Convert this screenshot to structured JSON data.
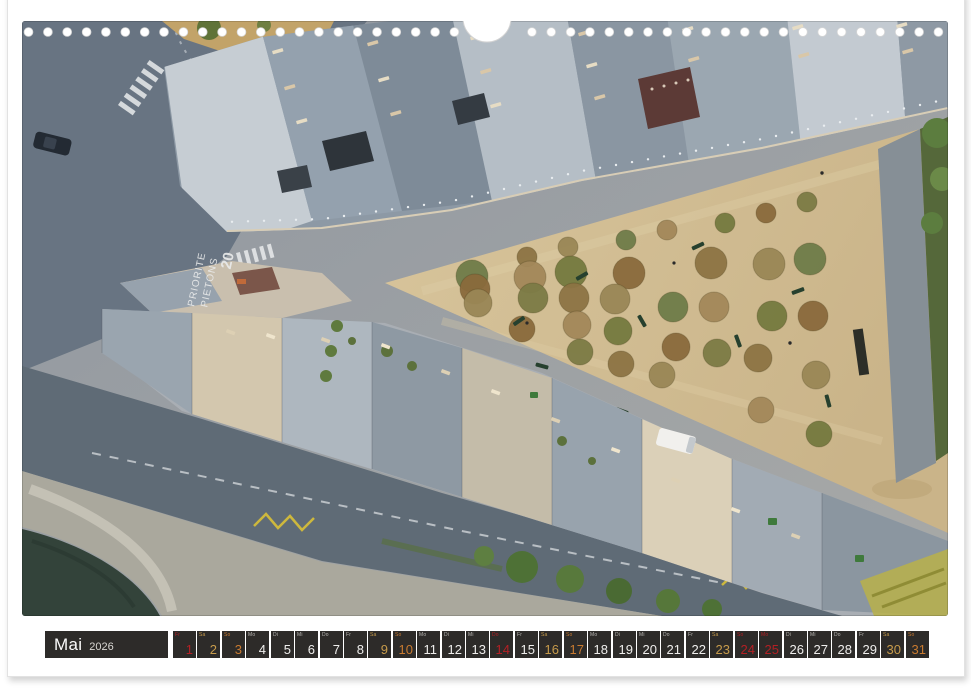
{
  "calendar_strip": {
    "month": "Mai",
    "year": "2026",
    "colors": {
      "cell_background": "#2d2b29",
      "weekday_text": "#efeeec",
      "weekday_label": "#b9b7b3",
      "saturday_text": "#c79b4b",
      "sunday_text": "#c87a30",
      "holiday_text": "#b32024"
    },
    "days": [
      {
        "date": "1",
        "weekday": "Fr",
        "kind": "holiday"
      },
      {
        "date": "2",
        "weekday": "Sa",
        "kind": "saturday"
      },
      {
        "date": "3",
        "weekday": "So",
        "kind": "sunday"
      },
      {
        "date": "4",
        "weekday": "Mo",
        "kind": "weekday"
      },
      {
        "date": "5",
        "weekday": "Di",
        "kind": "weekday"
      },
      {
        "date": "6",
        "weekday": "Mi",
        "kind": "weekday"
      },
      {
        "date": "7",
        "weekday": "Do",
        "kind": "weekday"
      },
      {
        "date": "8",
        "weekday": "Fr",
        "kind": "weekday"
      },
      {
        "date": "9",
        "weekday": "Sa",
        "kind": "saturday"
      },
      {
        "date": "10",
        "weekday": "So",
        "kind": "sunday"
      },
      {
        "date": "11",
        "weekday": "Mo",
        "kind": "weekday"
      },
      {
        "date": "12",
        "weekday": "Di",
        "kind": "weekday"
      },
      {
        "date": "13",
        "weekday": "Mi",
        "kind": "weekday"
      },
      {
        "date": "14",
        "weekday": "Do",
        "kind": "holiday"
      },
      {
        "date": "15",
        "weekday": "Fr",
        "kind": "weekday"
      },
      {
        "date": "16",
        "weekday": "Sa",
        "kind": "saturday"
      },
      {
        "date": "17",
        "weekday": "So",
        "kind": "sunday"
      },
      {
        "date": "18",
        "weekday": "Mo",
        "kind": "weekday"
      },
      {
        "date": "19",
        "weekday": "Di",
        "kind": "weekday"
      },
      {
        "date": "20",
        "weekday": "Mi",
        "kind": "weekday"
      },
      {
        "date": "21",
        "weekday": "Do",
        "kind": "weekday"
      },
      {
        "date": "22",
        "weekday": "Fr",
        "kind": "weekday"
      },
      {
        "date": "23",
        "weekday": "Sa",
        "kind": "saturday"
      },
      {
        "date": "24",
        "weekday": "So",
        "kind": "holiday"
      },
      {
        "date": "25",
        "weekday": "Mo",
        "kind": "holiday"
      },
      {
        "date": "26",
        "weekday": "Di",
        "kind": "weekday"
      },
      {
        "date": "27",
        "weekday": "Mi",
        "kind": "weekday"
      },
      {
        "date": "28",
        "weekday": "Do",
        "kind": "weekday"
      },
      {
        "date": "29",
        "weekday": "Fr",
        "kind": "weekday"
      },
      {
        "date": "30",
        "weekday": "Sa",
        "kind": "saturday"
      },
      {
        "date": "31",
        "weekday": "So",
        "kind": "sunday"
      }
    ]
  },
  "photo": {
    "description": "Aerial top-down view of Place Dauphine, Paris: wedge-shaped rows of Haussmann buildings with zinc rooftops, a sandy triangular square with autumn trees and benches, cobbled streets, quay and Seine water at lower left",
    "road_markings": {
      "zone_speed": "20",
      "line1": "PIETONS",
      "line2": "PRIORITE"
    }
  }
}
